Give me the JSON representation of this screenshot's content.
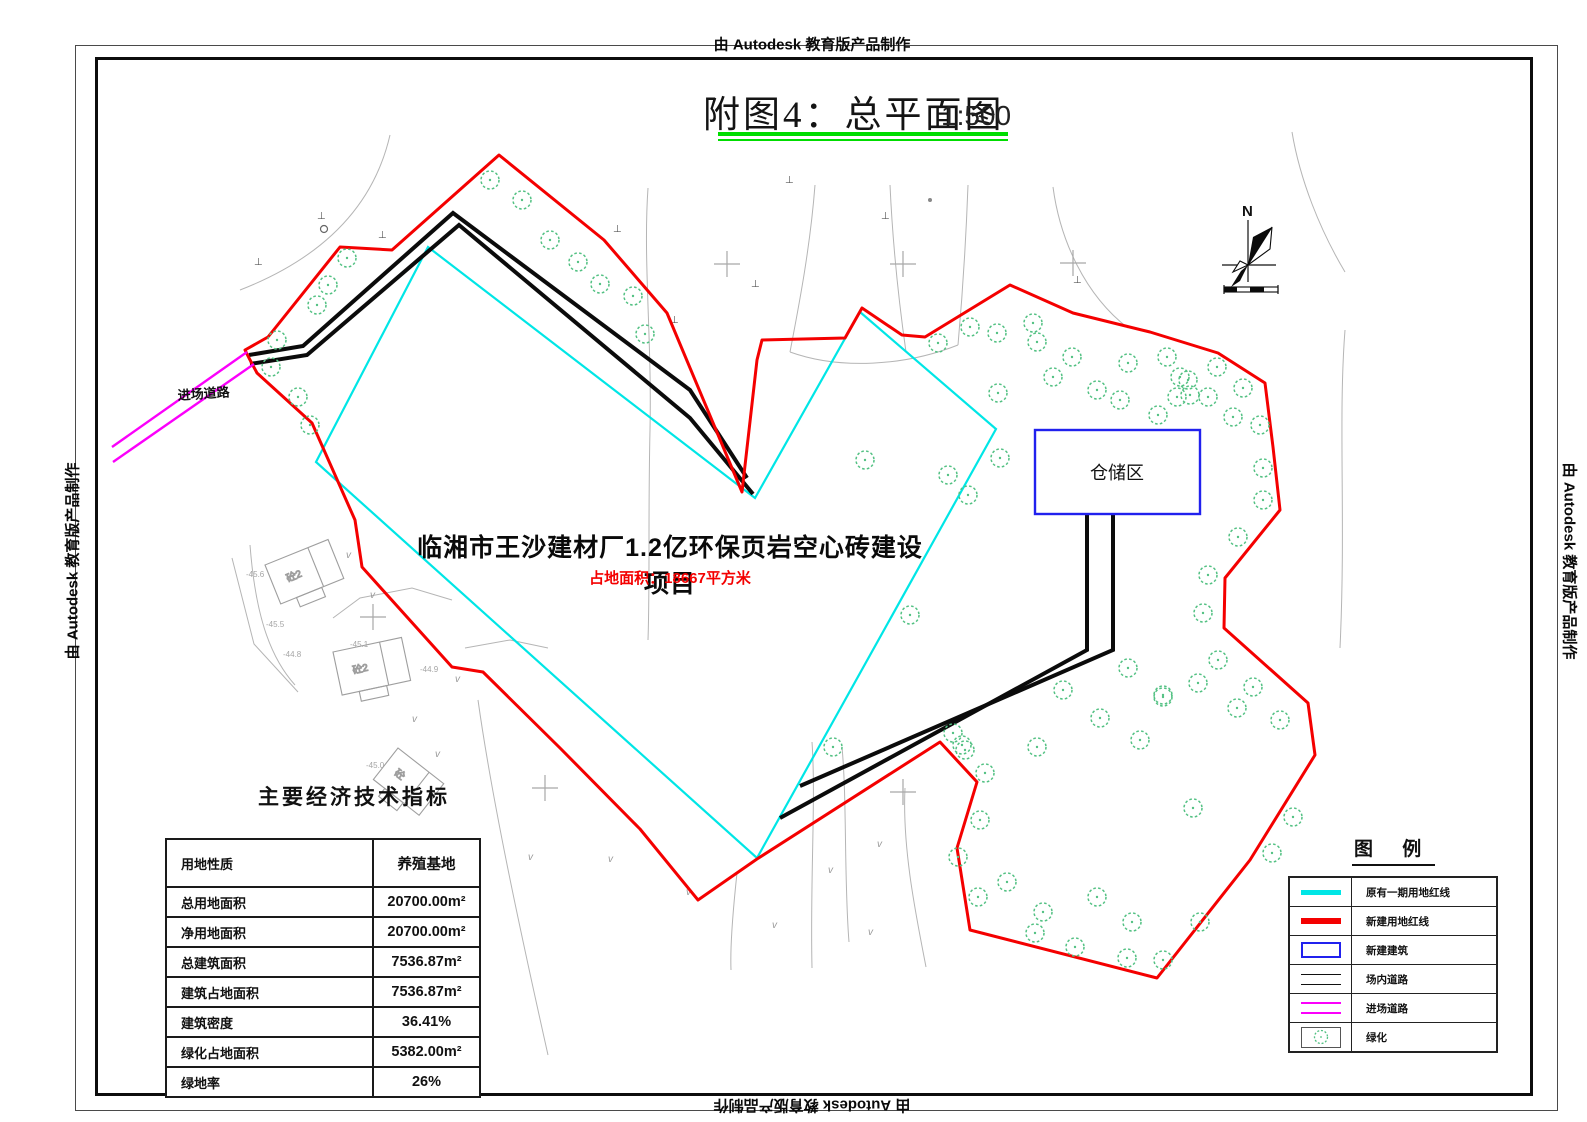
{
  "frame": {
    "watermark": "由 Autodesk 教育版产品制作"
  },
  "title": {
    "text": "附图4：总平面图",
    "scale": "1:500",
    "underline_color": "#00dd00"
  },
  "project": {
    "name": "临湘市王沙建材厂1.2亿环保页岩空心砖建设项目",
    "area_note": "占地面积：18667平方米",
    "area_color": "#f40000"
  },
  "storage": {
    "label": "仓储区"
  },
  "entry_road_label": "进场道路",
  "north": {
    "label": "N"
  },
  "stats_table": {
    "title": "主要经济技术指标",
    "rows": [
      {
        "label": "用地性质",
        "value": "养殖基地"
      },
      {
        "label": "总用地面积",
        "value": "20700.00m²"
      },
      {
        "label": "净用地面积",
        "value": "20700.00m²"
      },
      {
        "label": "总建筑面积",
        "value": "7536.87m²"
      },
      {
        "label": "建筑占地面积",
        "value": "7536.87m²"
      },
      {
        "label": "建筑密度",
        "value": "36.41%"
      },
      {
        "label": "绿化占地面积",
        "value": "5382.00m²"
      },
      {
        "label": "绿地率",
        "value": "26%"
      }
    ]
  },
  "legend": {
    "title": "图  例",
    "items": [
      {
        "label": "原有一期用地红线"
      },
      {
        "label": "新建用地红线"
      },
      {
        "label": "新建建筑"
      },
      {
        "label": "场内道路"
      },
      {
        "label": "进场道路"
      },
      {
        "label": "绿化"
      }
    ]
  },
  "colors": {
    "cyan": "#00e6e6",
    "red": "#f40000",
    "blue": "#2121ee",
    "magenta": "#fb00fb",
    "tree_green": "#53c183",
    "underline_green": "#00dd00"
  },
  "plan": {
    "red_boundary": [
      [
        245,
        350
      ],
      [
        268,
        337
      ],
      [
        340,
        247
      ],
      [
        392,
        250
      ],
      [
        499,
        155
      ],
      [
        604,
        240
      ],
      [
        667,
        313
      ],
      [
        742,
        492
      ],
      [
        757,
        360
      ],
      [
        762,
        340
      ],
      [
        845,
        338
      ],
      [
        862,
        308
      ],
      [
        902,
        335
      ],
      [
        925,
        337
      ],
      [
        1010,
        285
      ],
      [
        1073,
        313
      ],
      [
        1150,
        332
      ],
      [
        1218,
        353
      ],
      [
        1265,
        383
      ],
      [
        1273,
        447
      ],
      [
        1280,
        510
      ],
      [
        1225,
        578
      ],
      [
        1224,
        628
      ],
      [
        1308,
        703
      ],
      [
        1315,
        755
      ],
      [
        1250,
        860
      ],
      [
        1157,
        978
      ],
      [
        970,
        930
      ],
      [
        957,
        848
      ],
      [
        977,
        782
      ],
      [
        940,
        742
      ],
      [
        757,
        859
      ],
      [
        698,
        900
      ],
      [
        640,
        829
      ],
      [
        560,
        748
      ],
      [
        483,
        672
      ],
      [
        452,
        667
      ],
      [
        362,
        567
      ],
      [
        355,
        520
      ],
      [
        312,
        423
      ],
      [
        257,
        373
      ],
      [
        249,
        358
      ]
    ],
    "cyan_boundary": [
      [
        428,
        247
      ],
      [
        755,
        498
      ],
      [
        860,
        312
      ],
      [
        996,
        429
      ],
      [
        757,
        858
      ],
      [
        316,
        462
      ]
    ],
    "roads_black": [
      [
        [
          249,
          355
        ],
        [
          303,
          346
        ],
        [
          453,
          213
        ],
        [
          690,
          390
        ],
        [
          747,
          478
        ]
      ],
      [
        [
          250,
          364
        ],
        [
          307,
          355
        ],
        [
          459,
          225
        ],
        [
          690,
          418
        ],
        [
          753,
          494
        ]
      ],
      [
        [
          780,
          818
        ],
        [
          1087,
          650
        ],
        [
          1087,
          515
        ]
      ],
      [
        [
          800,
          786
        ],
        [
          1113,
          650
        ],
        [
          1113,
          515
        ]
      ]
    ],
    "roads_magenta": [
      [
        [
          112,
          447
        ],
        [
          247,
          352
        ]
      ],
      [
        [
          113,
          462
        ],
        [
          254,
          364
        ]
      ]
    ],
    "storage_box": {
      "x": 1035,
      "y": 430,
      "w": 165,
      "h": 84
    },
    "trees": [
      [
        490,
        180
      ],
      [
        522,
        200
      ],
      [
        550,
        240
      ],
      [
        578,
        262
      ],
      [
        600,
        284
      ],
      [
        633,
        296
      ],
      [
        645,
        334
      ],
      [
        347,
        258
      ],
      [
        328,
        285
      ],
      [
        317,
        305
      ],
      [
        277,
        340
      ],
      [
        271,
        367
      ],
      [
        298,
        397
      ],
      [
        310,
        425
      ],
      [
        938,
        343
      ],
      [
        970,
        327
      ],
      [
        997,
        333
      ],
      [
        1033,
        323
      ],
      [
        1037,
        342
      ],
      [
        1072,
        357
      ],
      [
        1053,
        377
      ],
      [
        998,
        393
      ],
      [
        1097,
        390
      ],
      [
        1120,
        400
      ],
      [
        1128,
        363
      ],
      [
        1167,
        357
      ],
      [
        1180,
        377
      ],
      [
        1190,
        395
      ],
      [
        1233,
        417
      ],
      [
        1243,
        388
      ],
      [
        1260,
        425
      ],
      [
        1158,
        415
      ],
      [
        1000,
        458
      ],
      [
        948,
        475
      ],
      [
        865,
        460
      ],
      [
        968,
        495
      ],
      [
        1217,
        367
      ],
      [
        1188,
        380
      ],
      [
        1177,
        397
      ],
      [
        1208,
        397
      ],
      [
        1263,
        468
      ],
      [
        1263,
        500
      ],
      [
        1238,
        537
      ],
      [
        1208,
        575
      ],
      [
        1203,
        613
      ],
      [
        1218,
        660
      ],
      [
        1198,
        683
      ],
      [
        1163,
        695
      ],
      [
        1253,
        687
      ],
      [
        833,
        747
      ],
      [
        962,
        745
      ],
      [
        910,
        615
      ],
      [
        1128,
        668
      ],
      [
        1063,
        690
      ],
      [
        1163,
        697
      ],
      [
        1237,
        708
      ],
      [
        1280,
        720
      ],
      [
        953,
        733
      ],
      [
        965,
        750
      ],
      [
        985,
        773
      ],
      [
        1100,
        718
      ],
      [
        1140,
        740
      ],
      [
        1037,
        747
      ],
      [
        1193,
        808
      ],
      [
        1293,
        817
      ],
      [
        980,
        820
      ],
      [
        958,
        857
      ],
      [
        1007,
        882
      ],
      [
        1043,
        912
      ],
      [
        1097,
        897
      ],
      [
        1132,
        922
      ],
      [
        1200,
        922
      ],
      [
        1272,
        853
      ],
      [
        978,
        897
      ],
      [
        1035,
        933
      ],
      [
        1075,
        947
      ],
      [
        1127,
        958
      ],
      [
        1163,
        960
      ]
    ],
    "contours": [
      "M 390,135 C 375,200 330,255 240,290",
      "M 648,188 C 643,260 652,340 650,430 C 648,520 650,580 648,640",
      "M 815,185 C 810,250 798,310 790,352",
      "M 890,185 C 893,250 900,310 906,352",
      "M 968,185 C 966,240 962,300 958,345",
      "M 790,352 C 840,370 905,366 958,345",
      "M 1053,187 C 1060,240 1085,295 1128,328",
      "M 1292,132 C 1300,180 1320,230 1345,272",
      "M 1345,330 C 1338,420 1346,520 1340,648",
      "M 905,788 C 902,850 917,920 926,967",
      "M 737,873 C 733,910 730,945 731,970",
      "M 812,742 C 816,800 810,880 812,968",
      "M 842,747 C 847,800 844,880 849,942",
      "M 478,700 C 492,800 520,930 548,1055",
      "M 250,545 C 255,610 268,655 295,685",
      "M 232,558 L 254,644 L 298,692",
      "M 333,618 L 360,598 L 412,588 L 452,600",
      "M 465,648 L 510,640 L 548,648"
    ],
    "crosses": [
      [
        727,
        264
      ],
      [
        903,
        264
      ],
      [
        1073,
        263
      ],
      [
        373,
        617
      ],
      [
        545,
        788
      ],
      [
        903,
        792
      ]
    ],
    "tmarks": [
      [
        317,
        219
      ],
      [
        378,
        238
      ],
      [
        254,
        265
      ],
      [
        613,
        232
      ],
      [
        670,
        323
      ],
      [
        785,
        183
      ],
      [
        881,
        219
      ],
      [
        751,
        287
      ],
      [
        1073,
        283
      ]
    ],
    "vmarks": [
      [
        686,
        895
      ],
      [
        772,
        928
      ],
      [
        828,
        873
      ],
      [
        868,
        935
      ],
      [
        877,
        847
      ],
      [
        346,
        558
      ],
      [
        370,
        598
      ],
      [
        412,
        722
      ],
      [
        435,
        757
      ],
      [
        455,
        682
      ],
      [
        528,
        860
      ],
      [
        608,
        862
      ]
    ],
    "elevations": [
      {
        "x": 246,
        "y": 577,
        "t": "-45.6"
      },
      {
        "x": 266,
        "y": 627,
        "t": "-45.5"
      },
      {
        "x": 283,
        "y": 657,
        "t": "-44.8"
      },
      {
        "x": 350,
        "y": 647,
        "t": "-45.1"
      },
      {
        "x": 420,
        "y": 672,
        "t": "-44.9"
      },
      {
        "x": 366,
        "y": 768,
        "t": "-45.0"
      }
    ],
    "buildings": [
      {
        "x": 265,
        "y": 565,
        "w": 68,
        "h": 42,
        "rot": -22,
        "label": "砼2"
      },
      {
        "x": 333,
        "y": 652,
        "w": 70,
        "h": 44,
        "rot": -12,
        "label": "砼2"
      },
      {
        "x": 398,
        "y": 748,
        "w": 58,
        "h": 40,
        "rot": 38,
        "label": "砼"
      }
    ],
    "circle": [
      324,
      229
    ],
    "dot": [
      930,
      200
    ]
  }
}
